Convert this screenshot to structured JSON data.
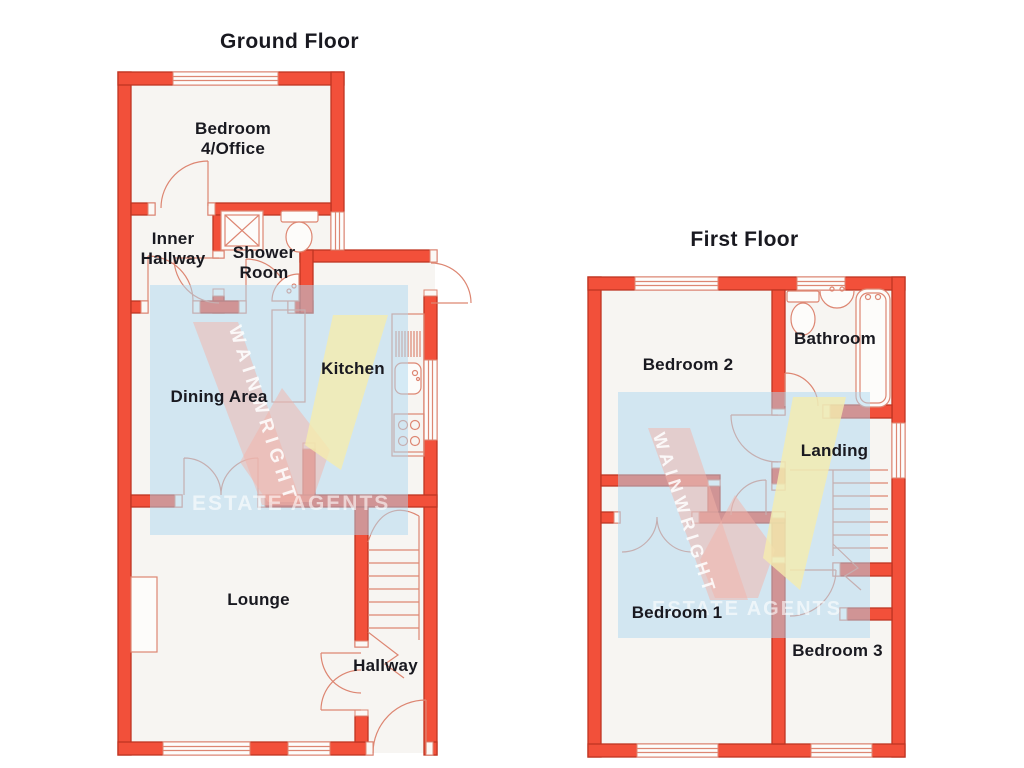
{
  "floors": [
    {
      "title": "Ground Floor",
      "rooms": [
        "Bedroom 4/Office",
        "Inner Hallway",
        "Shower Room",
        "Kitchen",
        "Dining Area",
        "Lounge",
        "Hallway"
      ]
    },
    {
      "title": "First Floor",
      "rooms": [
        "Bedroom 2",
        "Bathroom",
        "Landing",
        "Bedroom 1",
        "Bedroom 3"
      ]
    }
  ],
  "watermark": {
    "name": "WAINWRIGHT",
    "tagline": "ESTATE AGENTS"
  },
  "colors": {
    "wall_fill": "#f2503a",
    "wall_stroke": "#bf3522",
    "fixture_line": "#dd8672",
    "floor_fill": "#f7f5f2",
    "label_text": "#191920",
    "watermark_blue": "#aed7ef",
    "watermark_pink": "#f3b3a9",
    "watermark_yellow": "#f5ecae"
  }
}
